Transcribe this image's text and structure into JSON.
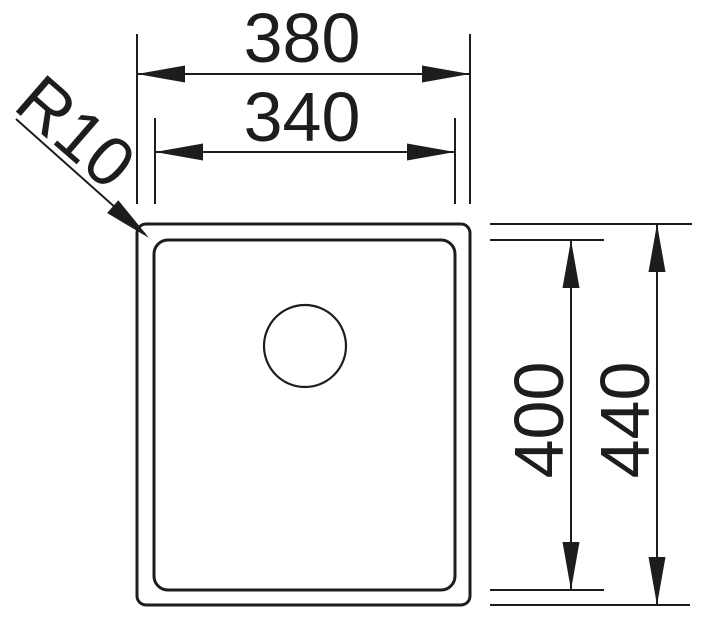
{
  "drawing": {
    "labels": {
      "width_outer": "380",
      "width_inner": "340",
      "depth_inner": "400",
      "depth_outer": "440",
      "corner_radius": "R10"
    },
    "colors": {
      "line": "#1d1d1b",
      "background": "#ffffff"
    }
  }
}
